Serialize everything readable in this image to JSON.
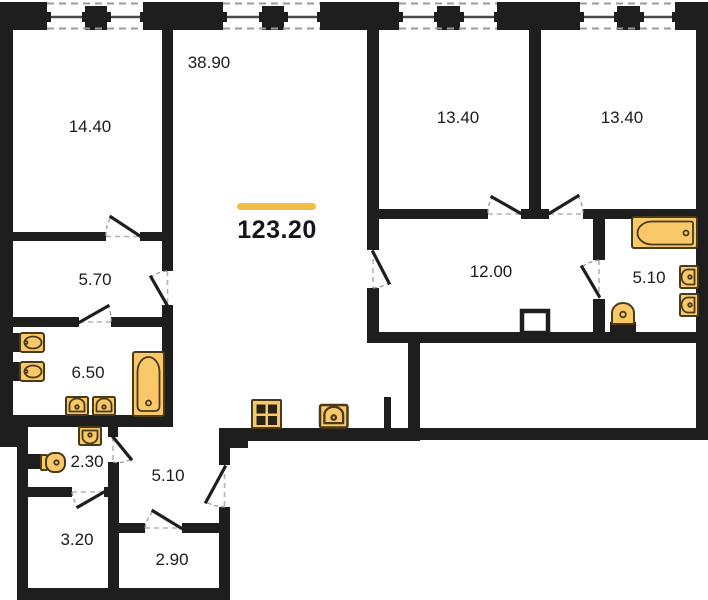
{
  "plan": {
    "type": "apartment-floor-plan",
    "total_area": {
      "value": "123.20"
    },
    "rooms": [
      {
        "id": "living-room",
        "area": "38.90"
      },
      {
        "id": "bedroom-left",
        "area": "14.40"
      },
      {
        "id": "bedroom-middle",
        "area": "13.40"
      },
      {
        "id": "bedroom-right",
        "area": "13.40"
      },
      {
        "id": "corridor",
        "area": "12.00"
      },
      {
        "id": "bathroom-right",
        "area": "5.10"
      },
      {
        "id": "hall-upper",
        "area": "5.70"
      },
      {
        "id": "bathroom-left",
        "area": "6.50"
      },
      {
        "id": "wc",
        "area": "2.30"
      },
      {
        "id": "hallway",
        "area": "5.10"
      },
      {
        "id": "storage",
        "area": "3.20"
      },
      {
        "id": "wardrobe",
        "area": "2.90"
      }
    ],
    "colors": {
      "walls": "#1E1E1E",
      "accent": "#F2BE45",
      "fixture_fill": "#F9C868",
      "fixture_stroke": "#4A3A17",
      "background": "#FFFFFF"
    },
    "fixtures": [
      "bathtub",
      "bathtub",
      "sink",
      "sink",
      "sink",
      "sink",
      "sink",
      "sink",
      "sink",
      "kitchen-sink",
      "stove",
      "toilet",
      "toilet"
    ],
    "window_count": 8,
    "door_count": 11
  }
}
